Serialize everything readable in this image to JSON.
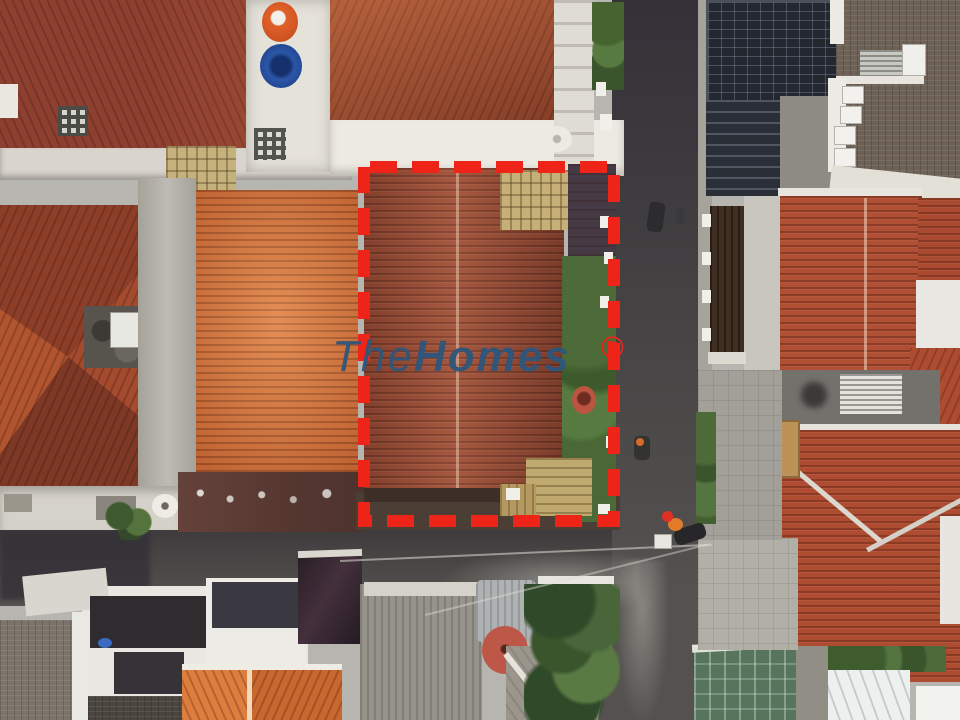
{
  "photo": {
    "kind": "aerial-drone-photograph",
    "subject": "residential neighborhood, top-down view, property outlined in red dashed boundary"
  },
  "watermark": {
    "brand_light": "The",
    "brand_bold": "Homes",
    "registered": "®",
    "text_color": "#2e567c",
    "mark_color": "#ee2418"
  },
  "boundary": {
    "style": "dashed",
    "color": "#ee2418"
  },
  "palette": {
    "roof_red_brown": "#9c4c36",
    "roof_bright_orange": "#d6733c",
    "roof_dark_red": "#8e4030",
    "road_asphalt": "#454345",
    "solar_panel": "#232730",
    "vegetation": "#4c6b38",
    "concrete": "#b7b5af"
  }
}
